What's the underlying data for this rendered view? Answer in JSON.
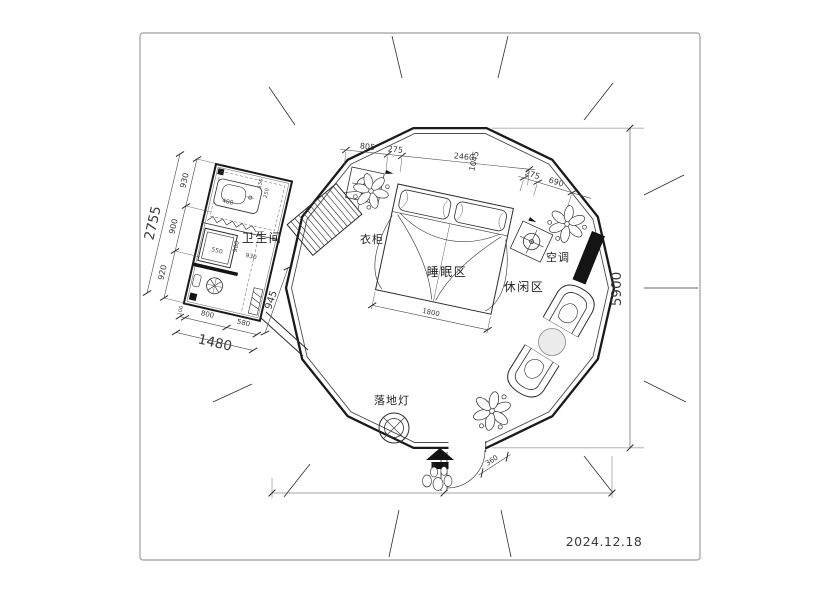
{
  "plan": {
    "date": "2024.12.18",
    "labels": {
      "bathroom": "卫生间",
      "wardrobe": "衣柜",
      "sleeping_area": "睡眠区",
      "leisure_area": "休闲区",
      "air_conditioner": "空调",
      "floor_lamp": "落地灯"
    },
    "dimensions": {
      "left_overall": "2755",
      "left_segment_top": "930",
      "left_segment_middle": "900",
      "left_segment_bottom": "920",
      "bathroom_bottom_overall": "1480",
      "bathroom_bottom_seg_small": "100",
      "bathroom_bottom_seg_1": "800",
      "bathroom_bottom_seg_2": "580",
      "bathroom_passage": "945",
      "shower": "550",
      "counter": "400",
      "bathroom_inner_1": "900",
      "bathroom_inner_2": "930",
      "bathroom_tiny_1": "150",
      "bathroom_tiny_2": "250",
      "top_seg_1": "805",
      "top_seg_2": "275",
      "top_overall": "2460",
      "top_cross": "1045",
      "top_right_seg_1": "275",
      "top_right_seg_2": "690",
      "bed_width": "1800",
      "height_overall": "5900",
      "entry_step": "360"
    }
  },
  "colors": {
    "ink": "#2b2b2b",
    "wall": "#1a1a1a",
    "frame": "#9e9e9e",
    "table_fill": "#ececec"
  }
}
